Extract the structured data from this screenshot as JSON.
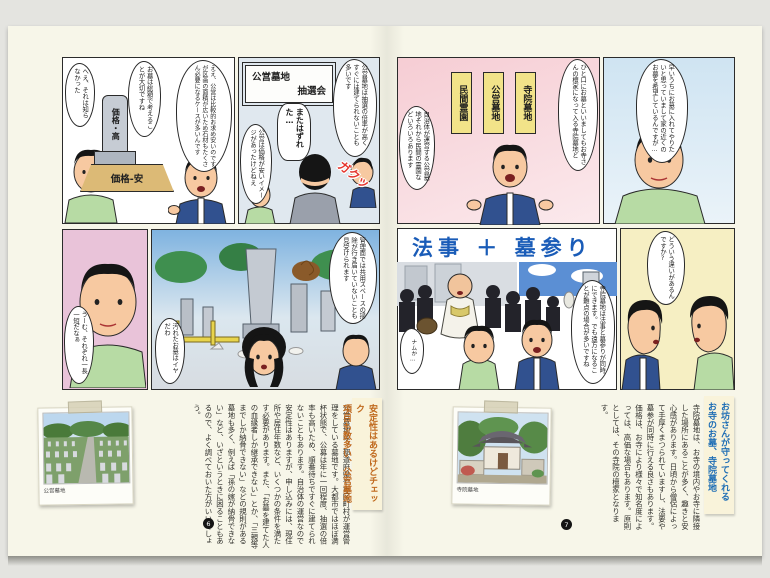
{
  "spread": {
    "left_page_number": "6",
    "right_page_number": "7"
  },
  "comic_left": {
    "panel_price": {
      "bubble_react": "へえ、それは知らなかった",
      "bubble_advice": "お墓は総額で考えることが大切ですね",
      "bubble_explain": "ええ、公営は比較的お求め安いのですが区画の面積が広いため石材もたくさん必要になるケースが多いんです",
      "tombstone_label": "価格・高",
      "base_label": "価格-安"
    },
    "panel_lottery": {
      "sign_line1": "公営墓地",
      "sign_line2": "抽選会",
      "bubble_rate": "公営墓地は抽選の倍率が高くすぐには建てられないことも多いです",
      "bubble_lost": "またはずれた…",
      "bubble_image": "公営は価格が安いイメージがあったけどねえ",
      "sfx": "ガクッ"
    },
    "panel_ponder": {
      "bubble": "うーむ、それぞれ一長一短だなぁ"
    },
    "panel_cemetery": {
      "bubble_manage": "管理面では共用スペースの掃除が行き届いていないことも見受けられます",
      "bubble_dirty": "汚れたお墓はイヤだわ"
    }
  },
  "comic_right": {
    "panel_types": {
      "signs": [
        "民間霊園",
        "公営墓地",
        "寺院墓地"
      ],
      "bubble_temple": "ひと口にお墓といいましてもお寺さんの檀家になって入る寺院墓地と",
      "bubble_public": "自治体が運営する公営墓地それから民間の霊園などいろいろあります"
    },
    "panel_wish": {
      "bubble": "早いうちにお墓に入れてやりたいと思っていまして家の近くのお墓を希望しているんですが…"
    },
    "panel_houji": {
      "banner": "法事 ＋ 墓参り",
      "bubble_monk": "ナムか…",
      "bubble_explain": "寺院墓地は法事と墓参りが同時にできます。でも遠方になることが難点の場合が多いですね"
    },
    "panel_question": {
      "bubble": "どういう違いがあるんですか?"
    }
  },
  "article_left": {
    "heading_line1": "安定性はあるけどチェック",
    "heading_line2": "項目も数多い、公営墓地",
    "body": "公営墓地は、都道府県や市区町村が運営管理をしている墓地です。大都市ではほぼ満杯状態で、公募は年に一回程度、抽選の倍率も高いため、順番待ちですぐに建てられないこともあります。自治体の運営なので安定性はありますが、申し込みには、現住所や居住年数など、いくつかの条件を満たす必要があります。また、「お墓を建てた人の血縁者しか継承できない」とか、「三親等までしか納骨できない」などの規則がある墓地も多く、例えば「孫の嫁が納骨できない」など、いざというときに困ることもあるので、よく調べておいた方がいいでしょう。",
    "photo_caption": "公営墓地"
  },
  "article_right": {
    "heading_line1": "お坊さんが守ってくれる",
    "heading_line2": "お寺のお墓、寺院墓地",
    "body": "寺院墓地は、お寺の境内やお寺に隣接した場所にあることが多く、趣きと安心感があります。日頃から僧侶によって手厚くまつられていますし、法要や墓参が同時に行える良さもあります。価格は、お寺により様々で知名度によっては、高価な場合もあります。原則としては、その寺院の檀家となります。",
    "photo_caption": "寺院墓地"
  },
  "colors": {
    "heading_left_accent": "#c06a1e",
    "heading_right_accent": "#1f6eb5",
    "banner_blue": "#1a5cb8",
    "page_background": "#f7f6e9"
  }
}
